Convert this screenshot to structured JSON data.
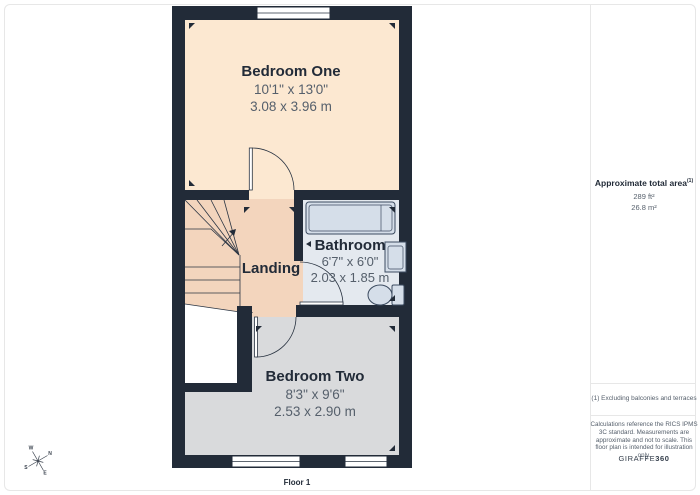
{
  "plan": {
    "floor_label": "Floor 1",
    "rooms": {
      "bedroom_one": {
        "name": "Bedroom One",
        "imperial": "10'1\" x 13'0\"",
        "metric": "3.08 x 3.96 m"
      },
      "landing": {
        "name": "Landing"
      },
      "bathroom": {
        "name": "Bathroom",
        "imperial": "6'7\" x 6'0\"",
        "metric": "2.03 x 1.85 m"
      },
      "bedroom_two": {
        "name": "Bedroom Two",
        "imperial": "8'3\" x 9'6\"",
        "metric": "2.53 x 2.90 m"
      }
    },
    "compass": {
      "n": "N",
      "e": "E",
      "s": "S",
      "w": "W"
    }
  },
  "sidebar": {
    "total_area_label": "Approximate total area",
    "total_area_sup": "(1)",
    "total_area_ft": "289 ft²",
    "total_area_m": "26.8 m²",
    "footnote": "(1) Excluding balconies and terraces",
    "disclaimer": "Calculations reference the RICS IPMS 3C standard. Measurements are approximate and not to scale. This floor plan is intended for illustration only.",
    "brand": "GIRAFFE",
    "brand_suffix": "360"
  },
  "colors": {
    "wall": "#222b38",
    "bedroom-one": "#fce8d1",
    "landing": "#f3d5bd",
    "bathroom": "#e4e9ef",
    "fixture": "#d5dee9",
    "bedroom-two": "#d9dadc",
    "ink": "#222b38",
    "muted": "#555f6b",
    "line": "#e7e7e7"
  }
}
